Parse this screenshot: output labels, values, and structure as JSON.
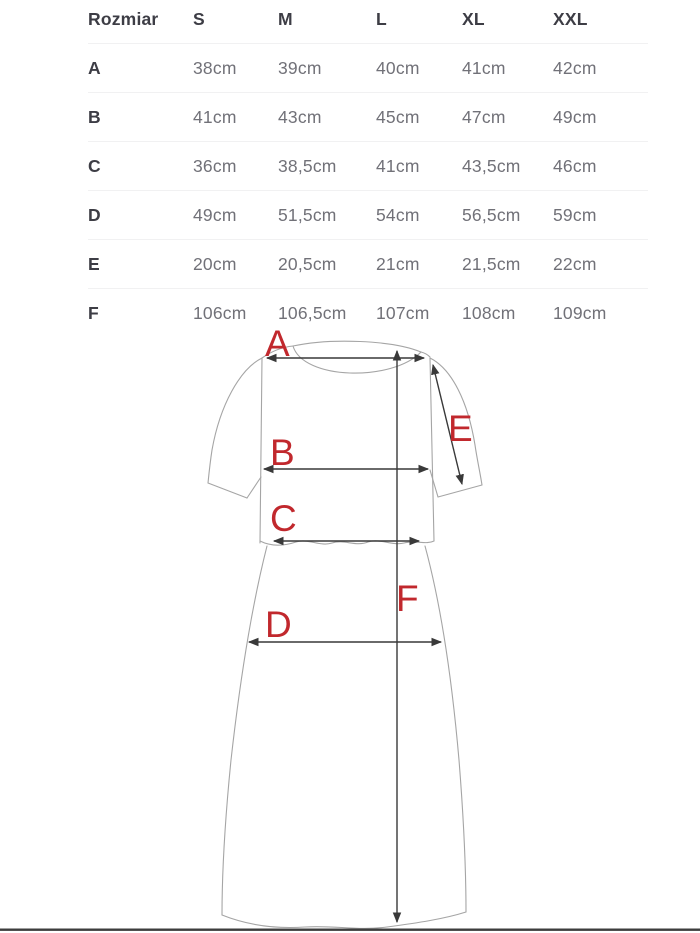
{
  "table": {
    "header": [
      "Rozmiar",
      "S",
      "M",
      "L",
      "XL",
      "XXL"
    ],
    "rows": [
      {
        "label": "A",
        "values": [
          "38cm",
          "39cm",
          "40cm",
          "41cm",
          "42cm"
        ]
      },
      {
        "label": "B",
        "values": [
          "41cm",
          "43cm",
          "45cm",
          "47cm",
          "49cm"
        ]
      },
      {
        "label": "C",
        "values": [
          "36cm",
          "38,5cm",
          "41cm",
          "43,5cm",
          "46cm"
        ]
      },
      {
        "label": "D",
        "values": [
          "49cm",
          "51,5cm",
          "54cm",
          "56,5cm",
          "59cm"
        ]
      },
      {
        "label": "E",
        "values": [
          "20cm",
          "20,5cm",
          "21cm",
          "21,5cm",
          "22cm"
        ]
      },
      {
        "label": "F",
        "values": [
          "106cm",
          "106,5cm",
          "107cm",
          "108cm",
          "109cm"
        ]
      }
    ]
  },
  "diagram": {
    "labels": {
      "A": "A",
      "B": "B",
      "C": "C",
      "D": "D",
      "E": "E",
      "F": "F"
    },
    "colors": {
      "label": "#c1282d",
      "outline": "#a5a5a5",
      "arrow": "#393939",
      "header_text": "#3d3d45",
      "value_text": "#717178"
    }
  }
}
